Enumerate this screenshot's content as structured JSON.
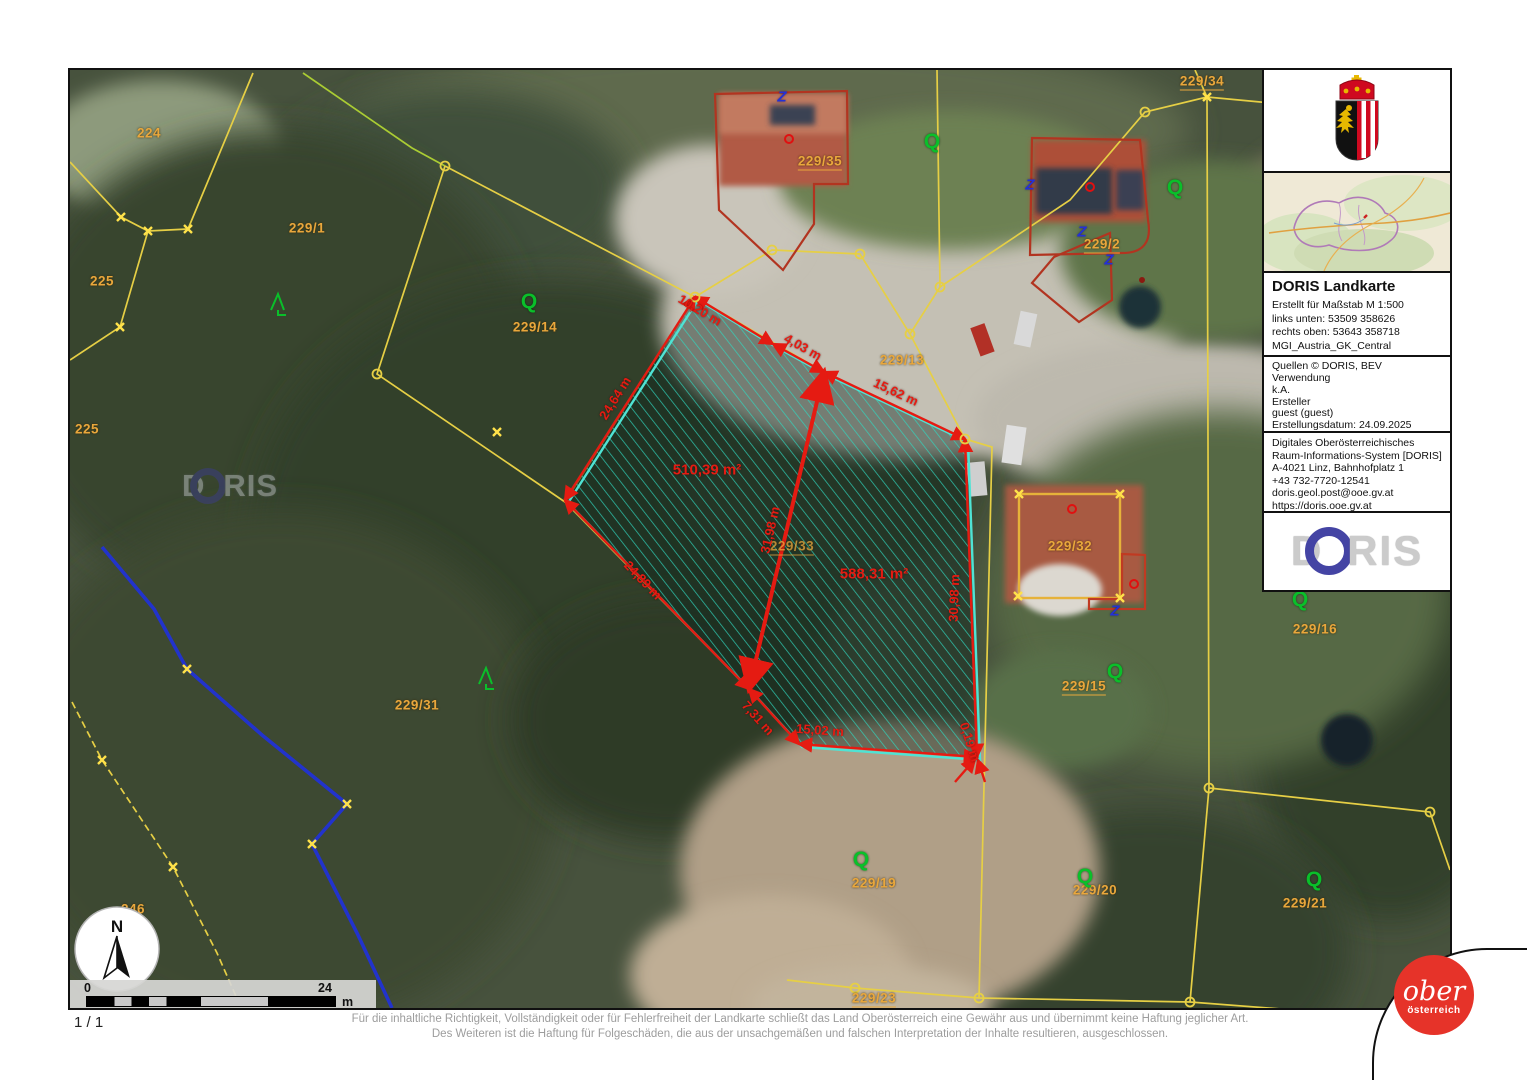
{
  "map": {
    "north": "N",
    "scale": {
      "start": "0",
      "end": "24",
      "unit": "m"
    },
    "watermark": {
      "d": "D",
      "ris": "RIS"
    },
    "symbol_q": "Q",
    "symbol_z": "Z",
    "parcels": [
      "224",
      "229/1",
      "225",
      "225",
      "229/14",
      "229/31",
      "246",
      "229/35",
      "229/13",
      "229/2",
      "229/34",
      "229/32",
      "229/15",
      "229/16",
      "229/33",
      "229/19",
      "229/20",
      "229/21",
      "229/23"
    ],
    "measures": [
      "10,20 m",
      "4,03 m",
      "15,62 m",
      "30,98 m",
      "15,02 m",
      "7,31 m",
      "0,19 m",
      "24,89 m",
      "24,64 m",
      "31,98 m"
    ],
    "areas": [
      "510,39 m²",
      "588,31 m²"
    ]
  },
  "sidebar": {
    "title": "DORIS Landkarte",
    "meta_lines": [
      "Erstellt für Maßstab M 1:500",
      "links unten: 53509 358626",
      "rechts oben: 53643 358718",
      "MGI_Austria_GK_Central"
    ],
    "source_lines": [
      "Quellen © DORIS, BEV",
      "Verwendung",
      "k.A.",
      "Ersteller",
      "guest (guest)",
      "Erstellungsdatum: 24.09.2025"
    ],
    "address_lines": [
      "Digitales Oberösterreichisches",
      "Raum-Informations-System [DORIS]",
      "A-4021 Linz, Bahnhofplatz 1",
      "+43 732-7720-12541",
      "doris.geol.post@ooe.gv.at",
      "https://doris.ooe.gv.at"
    ],
    "logo": {
      "d": "D",
      "ris": "RIS"
    }
  },
  "footer": {
    "page": "1 / 1",
    "line1": "Für die inhaltliche Richtigkeit, Vollständigkeit oder für Fehlerfreiheit der Landkarte schließt das Land Oberösterreich eine Gewähr aus und übernimmt keine Haftung jeglicher Art.",
    "line2": "Des Weiteren ist die Haftung für Folgeschäden, die aus der unsachgemäßen und falschen Interpretation der Inhalte resultieren, ausgeschlossen."
  },
  "ooe_logo": {
    "script": "ober",
    "sub": "österreich"
  },
  "colors": {
    "parcel_line": "#e6cf45",
    "measure_red": "#e51b12",
    "boundary_cyan": "#4fe3d4",
    "stream_blue": "#2233cc",
    "label_orange": "#e9a73c",
    "symbol_green": "#0abf2a",
    "ooe_red": "#e63329",
    "doris_blue": "#4444a4"
  }
}
